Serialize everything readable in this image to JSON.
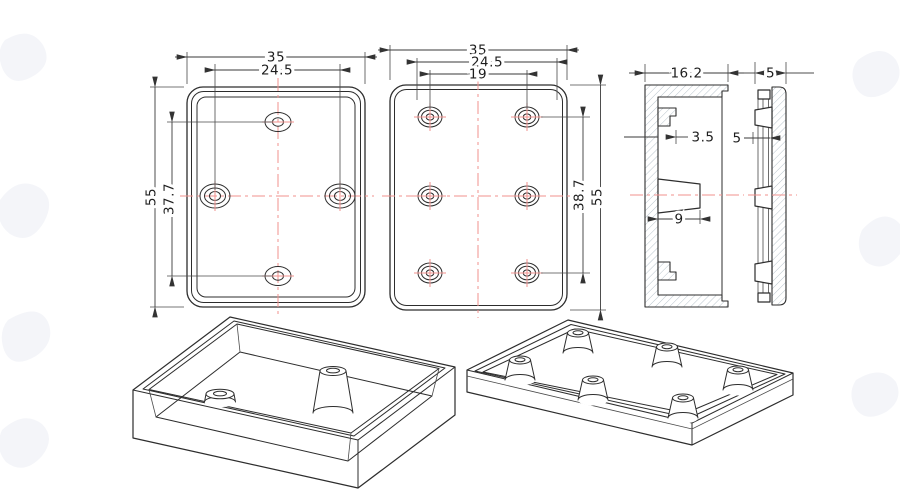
{
  "meta": {
    "background": "#ffffff",
    "line_color": "#2d2d2d",
    "dimension_color": "#3a3a3a",
    "centerline_color": "#f2918e",
    "hatch_color": "#b9c4cc",
    "watermark_color": "#f4f5f9"
  },
  "views": {
    "front": {
      "dim_width": "35",
      "dim_hole_span": "24.5",
      "dim_height": "55",
      "dim_hole_span_v": "37.7"
    },
    "back": {
      "dim_width": "35",
      "dim_outer_span": "24.5",
      "dim_boss_span": "19",
      "dim_row_span": "38.7",
      "dim_height": "55"
    },
    "section_box": {
      "dim_width": "16.2",
      "dim_clip_depth": "3.5",
      "dim_boss_width": "9"
    },
    "section_lid": {
      "dim_thickness": "5",
      "dim_boss_height": "5"
    }
  }
}
